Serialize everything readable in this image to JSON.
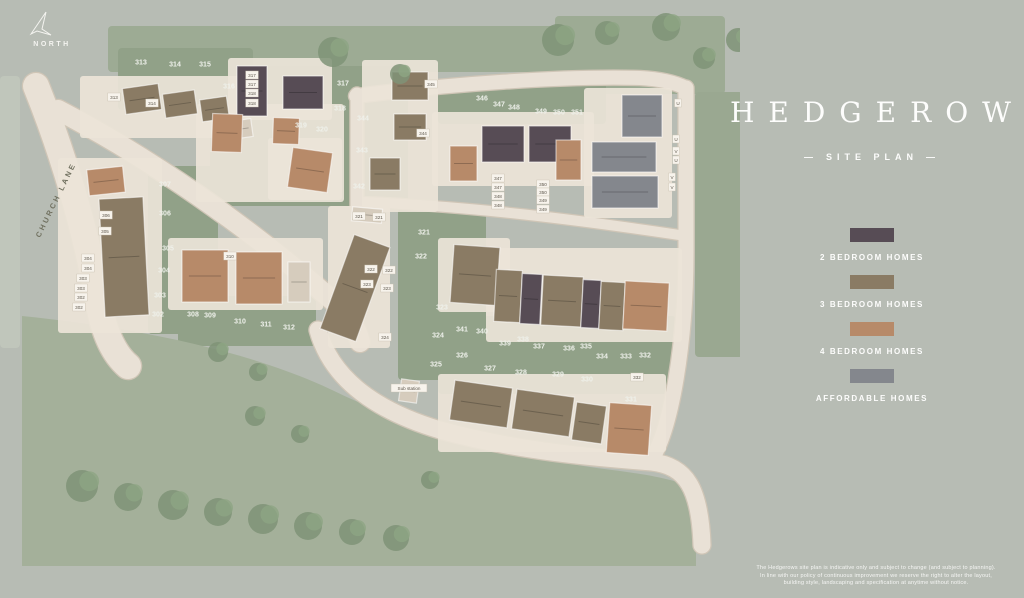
{
  "panel": {
    "title": "HEDGEROWS",
    "subtitle": "SITE PLAN",
    "subtitle_dash": "—",
    "legend": {
      "items": [
        {
          "label": "2 BEDROOM HOMES",
          "color": "#574c55"
        },
        {
          "label": "3 BEDROOM HOMES",
          "color": "#8a7b64"
        },
        {
          "label": "4 BEDROOM HOMES",
          "color": "#b78a69"
        },
        {
          "label": "AFFORDABLE HOMES",
          "color": "#84878d"
        }
      ]
    },
    "disclaimer": [
      "The Hedgerows site plan is indicative only and subject to change (and subject to planning).",
      "In line with our policy of continuous improvement we reserve the right to alter the layout,",
      "building style, landscaping and specification at anytime without notice."
    ]
  },
  "map": {
    "north_label": "NORTH",
    "road_label": "CHURCH LANE",
    "colors": {
      "green": "#91a188",
      "field": "#a4b09a",
      "tree": "#7f9377",
      "tree2": "#8da583",
      "road": "#e9e1d6",
      "road_edge": "#cfc5b6",
      "parcel": "#ebe4d8",
      "b2": "#574c55",
      "b3": "#8a7b64",
      "b4": "#b78a69",
      "af": "#84878d",
      "g": "#d6ccbd",
      "label": "#eff1eb",
      "box_bg": "#f7f3ec",
      "box_text": "#5c564b",
      "lane_text": "#70705f"
    },
    "patches": [
      {
        "x": 108,
        "y": 26,
        "w": 615,
        "h": 46,
        "f": "#9dab94"
      },
      {
        "x": 555,
        "y": 16,
        "w": 170,
        "h": 78,
        "f": "#9dab94"
      },
      {
        "x": 118,
        "y": 48,
        "w": 135,
        "h": 62
      },
      {
        "x": 210,
        "y": 66,
        "w": 150,
        "h": 140
      },
      {
        "x": 338,
        "y": 66,
        "w": 70,
        "h": 140
      },
      {
        "x": 438,
        "y": 82,
        "w": 168,
        "h": 42
      },
      {
        "x": 148,
        "y": 166,
        "w": 70,
        "h": 168
      },
      {
        "x": 178,
        "y": 296,
        "w": 138,
        "h": 50
      },
      {
        "x": 398,
        "y": 208,
        "w": 88,
        "h": 172
      },
      {
        "x": 438,
        "y": 316,
        "w": 238,
        "h": 78
      },
      {
        "x": 695,
        "y": 92,
        "w": 48,
        "h": 265,
        "f": "#9aa891"
      },
      {
        "d": "M 22,316 C 140,328 252,352 332,390 C 402,424 500,456 612,470 C 652,475 682,481 696,490 L 696,566 L 22,566 Z",
        "f": "#a4b09a"
      },
      {
        "x": 0,
        "y": 76,
        "w": 20,
        "h": 272,
        "f": "#c0c6bb"
      }
    ],
    "roads": [
      {
        "d": "M 36,86 C 62,150 86,230 98,300 C 104,334 114,354 128,366",
        "w": 26
      },
      {
        "d": "M 58,110 C 150,158 250,228 332,300 C 348,314 356,326 360,342",
        "w": 20
      },
      {
        "d": "M 318,330 C 332,382 380,412 440,430 C 520,452 600,458 652,462 C 686,466 700,488 702,545",
        "w": 17
      },
      {
        "d": "M 686,88 L 686,250 C 686,340 672,430 650,462",
        "w": 15
      },
      {
        "d": "M 356,96 C 450,84 560,76 640,78 C 660,79 674,82 686,88",
        "w": 14
      },
      {
        "d": "M 357,94 L 357,206",
        "w": 13
      },
      {
        "d": "M 360,202 C 470,206 580,220 686,236",
        "w": 10
      }
    ],
    "parcels": [
      {
        "x": 80,
        "y": 76,
        "w": 162,
        "h": 62
      },
      {
        "x": 228,
        "y": 58,
        "w": 104,
        "h": 62
      },
      {
        "x": 196,
        "y": 104,
        "w": 148,
        "h": 98
      },
      {
        "x": 268,
        "y": 138,
        "w": 74,
        "h": 62
      },
      {
        "x": 362,
        "y": 60,
        "w": 76,
        "h": 152
      },
      {
        "x": 432,
        "y": 112,
        "w": 162,
        "h": 74
      },
      {
        "x": 584,
        "y": 88,
        "w": 88,
        "h": 130
      },
      {
        "x": 58,
        "y": 158,
        "w": 104,
        "h": 175
      },
      {
        "x": 168,
        "y": 238,
        "w": 155,
        "h": 72
      },
      {
        "x": 328,
        "y": 206,
        "w": 62,
        "h": 142
      },
      {
        "x": 438,
        "y": 238,
        "w": 72,
        "h": 74
      },
      {
        "x": 486,
        "y": 248,
        "w": 196,
        "h": 94
      },
      {
        "x": 438,
        "y": 374,
        "w": 228,
        "h": 78
      }
    ],
    "trees": [
      {
        "x": 333,
        "y": 52,
        "r": 15
      },
      {
        "x": 400,
        "y": 74,
        "r": 10
      },
      {
        "x": 558,
        "y": 40,
        "r": 16
      },
      {
        "x": 607,
        "y": 33,
        "r": 12
      },
      {
        "x": 666,
        "y": 27,
        "r": 14
      },
      {
        "x": 704,
        "y": 58,
        "r": 11
      },
      {
        "x": 738,
        "y": 40,
        "r": 12
      },
      {
        "x": 218,
        "y": 352,
        "r": 10
      },
      {
        "x": 258,
        "y": 372,
        "r": 9
      },
      {
        "x": 82,
        "y": 486,
        "r": 16
      },
      {
        "x": 128,
        "y": 497,
        "r": 14
      },
      {
        "x": 173,
        "y": 505,
        "r": 15
      },
      {
        "x": 218,
        "y": 512,
        "r": 14
      },
      {
        "x": 263,
        "y": 519,
        "r": 15
      },
      {
        "x": 308,
        "y": 526,
        "r": 14
      },
      {
        "x": 352,
        "y": 532,
        "r": 13
      },
      {
        "x": 396,
        "y": 538,
        "r": 13
      },
      {
        "x": 255,
        "y": 416,
        "r": 10
      },
      {
        "x": 300,
        "y": 434,
        "r": 9
      },
      {
        "x": 430,
        "y": 480,
        "r": 9
      }
    ],
    "houses": [
      {
        "x": 124,
        "y": 86,
        "w": 36,
        "h": 26,
        "r": -8,
        "c": "b3"
      },
      {
        "x": 164,
        "y": 92,
        "w": 32,
        "h": 24,
        "r": -8,
        "c": "b3"
      },
      {
        "x": 201,
        "y": 98,
        "w": 27,
        "h": 22,
        "r": -8,
        "c": "b3"
      },
      {
        "x": 230,
        "y": 120,
        "w": 22,
        "h": 18,
        "r": -8,
        "c": "g"
      },
      {
        "x": 237,
        "y": 66,
        "w": 30,
        "h": 50,
        "r": 0,
        "c": "b2"
      },
      {
        "x": 283,
        "y": 76,
        "w": 40,
        "h": 33,
        "r": 0,
        "c": "b2"
      },
      {
        "x": 212,
        "y": 114,
        "w": 30,
        "h": 38,
        "r": 2,
        "c": "b4"
      },
      {
        "x": 273,
        "y": 118,
        "w": 26,
        "h": 26,
        "r": 2,
        "c": "b4"
      },
      {
        "x": 290,
        "y": 150,
        "w": 40,
        "h": 40,
        "r": 8,
        "c": "b4"
      },
      {
        "x": 392,
        "y": 72,
        "w": 36,
        "h": 28,
        "r": 0,
        "c": "b3"
      },
      {
        "x": 394,
        "y": 114,
        "w": 32,
        "h": 26,
        "r": 0,
        "c": "b3"
      },
      {
        "x": 370,
        "y": 158,
        "w": 30,
        "h": 32,
        "r": 0,
        "c": "b3"
      },
      {
        "x": 450,
        "y": 146,
        "w": 27,
        "h": 35,
        "r": 0,
        "c": "b4"
      },
      {
        "x": 482,
        "y": 126,
        "w": 42,
        "h": 36,
        "r": 0,
        "c": "b2"
      },
      {
        "x": 529,
        "y": 126,
        "w": 42,
        "h": 36,
        "r": 0,
        "c": "b2"
      },
      {
        "x": 556,
        "y": 140,
        "w": 25,
        "h": 40,
        "r": 0,
        "c": "b4"
      },
      {
        "x": 622,
        "y": 95,
        "w": 40,
        "h": 42,
        "r": 0,
        "c": "af"
      },
      {
        "x": 592,
        "y": 142,
        "w": 64,
        "h": 30,
        "r": 0,
        "c": "af"
      },
      {
        "x": 592,
        "y": 176,
        "w": 66,
        "h": 32,
        "r": 0,
        "c": "af"
      },
      {
        "x": 88,
        "y": 168,
        "w": 36,
        "h": 26,
        "r": -6,
        "c": "b4"
      },
      {
        "x": 102,
        "y": 198,
        "w": 44,
        "h": 118,
        "r": -3,
        "c": "b3"
      },
      {
        "x": 182,
        "y": 250,
        "w": 46,
        "h": 52,
        "r": 0,
        "c": "b4"
      },
      {
        "x": 236,
        "y": 252,
        "w": 46,
        "h": 52,
        "r": 0,
        "c": "b4"
      },
      {
        "x": 288,
        "y": 262,
        "w": 22,
        "h": 40,
        "r": 0,
        "c": "g"
      },
      {
        "x": 336,
        "y": 238,
        "w": 38,
        "h": 100,
        "r": 20,
        "c": "b3"
      },
      {
        "x": 352,
        "y": 208,
        "w": 30,
        "h": 14,
        "r": 5,
        "c": "g"
      },
      {
        "x": 452,
        "y": 246,
        "w": 46,
        "h": 58,
        "r": 4,
        "c": "b3"
      },
      {
        "x": 495,
        "y": 270,
        "w": 26,
        "h": 52,
        "r": 3,
        "c": "b3"
      },
      {
        "x": 521,
        "y": 274,
        "w": 20,
        "h": 50,
        "r": 3,
        "c": "b2"
      },
      {
        "x": 542,
        "y": 276,
        "w": 40,
        "h": 50,
        "r": 3,
        "c": "b3"
      },
      {
        "x": 582,
        "y": 280,
        "w": 18,
        "h": 48,
        "r": 3,
        "c": "b2"
      },
      {
        "x": 600,
        "y": 282,
        "w": 24,
        "h": 48,
        "r": 3,
        "c": "b3"
      },
      {
        "x": 624,
        "y": 282,
        "w": 44,
        "h": 48,
        "r": 3,
        "c": "b4"
      },
      {
        "x": 452,
        "y": 384,
        "w": 58,
        "h": 40,
        "r": 8,
        "c": "b3"
      },
      {
        "x": 514,
        "y": 393,
        "w": 58,
        "h": 40,
        "r": 8,
        "c": "b3"
      },
      {
        "x": 574,
        "y": 404,
        "w": 30,
        "h": 38,
        "r": 8,
        "c": "b3"
      },
      {
        "x": 608,
        "y": 404,
        "w": 42,
        "h": 50,
        "r": 4,
        "c": "b4"
      },
      {
        "x": 400,
        "y": 380,
        "w": 18,
        "h": 22,
        "r": 8,
        "c": "g"
      }
    ],
    "plot_labels": [
      {
        "t": "313",
        "x": 141,
        "y": 62
      },
      {
        "t": "314",
        "x": 175,
        "y": 64
      },
      {
        "t": "315",
        "x": 205,
        "y": 64
      },
      {
        "t": "316",
        "x": 229,
        "y": 86
      },
      {
        "t": "317",
        "x": 343,
        "y": 83
      },
      {
        "t": "318",
        "x": 340,
        "y": 108
      },
      {
        "t": "319",
        "x": 301,
        "y": 125
      },
      {
        "t": "320",
        "x": 322,
        "y": 129
      },
      {
        "t": "344",
        "x": 363,
        "y": 118
      },
      {
        "t": "343",
        "x": 362,
        "y": 150
      },
      {
        "t": "342",
        "x": 359,
        "y": 186
      },
      {
        "t": "307",
        "x": 165,
        "y": 184
      },
      {
        "t": "306",
        "x": 165,
        "y": 213
      },
      {
        "t": "305",
        "x": 168,
        "y": 248
      },
      {
        "t": "304",
        "x": 164,
        "y": 270
      },
      {
        "t": "303",
        "x": 160,
        "y": 295
      },
      {
        "t": "302",
        "x": 158,
        "y": 314
      },
      {
        "t": "308",
        "x": 193,
        "y": 314
      },
      {
        "t": "309",
        "x": 210,
        "y": 315
      },
      {
        "t": "310",
        "x": 240,
        "y": 321
      },
      {
        "t": "311",
        "x": 266,
        "y": 324
      },
      {
        "t": "312",
        "x": 289,
        "y": 327
      },
      {
        "t": "321",
        "x": 424,
        "y": 232
      },
      {
        "t": "322",
        "x": 421,
        "y": 256
      },
      {
        "t": "323",
        "x": 442,
        "y": 307
      },
      {
        "t": "324",
        "x": 438,
        "y": 335
      },
      {
        "t": "325",
        "x": 436,
        "y": 364
      },
      {
        "t": "326",
        "x": 462,
        "y": 355
      },
      {
        "t": "327",
        "x": 490,
        "y": 368
      },
      {
        "t": "328",
        "x": 521,
        "y": 372
      },
      {
        "t": "329",
        "x": 558,
        "y": 374
      },
      {
        "t": "330",
        "x": 587,
        "y": 379
      },
      {
        "t": "331",
        "x": 631,
        "y": 399
      },
      {
        "t": "341",
        "x": 462,
        "y": 329
      },
      {
        "t": "340",
        "x": 482,
        "y": 331
      },
      {
        "t": "339",
        "x": 505,
        "y": 343
      },
      {
        "t": "338",
        "x": 523,
        "y": 339
      },
      {
        "t": "337",
        "x": 539,
        "y": 346
      },
      {
        "t": "336",
        "x": 569,
        "y": 348
      },
      {
        "t": "335",
        "x": 586,
        "y": 346
      },
      {
        "t": "334",
        "x": 602,
        "y": 356
      },
      {
        "t": "333",
        "x": 626,
        "y": 356
      },
      {
        "t": "332",
        "x": 645,
        "y": 355
      },
      {
        "t": "346",
        "x": 482,
        "y": 98
      },
      {
        "t": "347",
        "x": 499,
        "y": 104
      },
      {
        "t": "348",
        "x": 514,
        "y": 107
      },
      {
        "t": "349",
        "x": 541,
        "y": 111
      },
      {
        "t": "350",
        "x": 559,
        "y": 112
      },
      {
        "t": "351",
        "x": 577,
        "y": 112
      }
    ],
    "box_labels": [
      {
        "t": "317",
        "x": 252,
        "y": 75
      },
      {
        "t": "317",
        "x": 252,
        "y": 84
      },
      {
        "t": "318",
        "x": 252,
        "y": 93
      },
      {
        "t": "318",
        "x": 252,
        "y": 103
      },
      {
        "t": "347",
        "x": 498,
        "y": 178
      },
      {
        "t": "347",
        "x": 498,
        "y": 187
      },
      {
        "t": "348",
        "x": 498,
        "y": 196
      },
      {
        "t": "348",
        "x": 498,
        "y": 205
      },
      {
        "t": "350",
        "x": 543,
        "y": 184
      },
      {
        "t": "350",
        "x": 543,
        "y": 192
      },
      {
        "t": "349",
        "x": 543,
        "y": 200
      },
      {
        "t": "349",
        "x": 543,
        "y": 209
      },
      {
        "t": "306",
        "x": 106,
        "y": 215
      },
      {
        "t": "305",
        "x": 105,
        "y": 231
      },
      {
        "t": "304",
        "x": 88,
        "y": 258
      },
      {
        "t": "304",
        "x": 88,
        "y": 268
      },
      {
        "t": "303",
        "x": 83,
        "y": 278
      },
      {
        "t": "303",
        "x": 81,
        "y": 288
      },
      {
        "t": "302",
        "x": 81,
        "y": 297
      },
      {
        "t": "302",
        "x": 79,
        "y": 307
      },
      {
        "t": "321",
        "x": 359,
        "y": 216
      },
      {
        "t": "321",
        "x": 379,
        "y": 217
      },
      {
        "t": "322",
        "x": 371,
        "y": 269
      },
      {
        "t": "322",
        "x": 389,
        "y": 270
      },
      {
        "t": "323",
        "x": 367,
        "y": 284
      },
      {
        "t": "323",
        "x": 387,
        "y": 288
      },
      {
        "t": "324",
        "x": 385,
        "y": 337
      },
      {
        "t": "332",
        "x": 637,
        "y": 377
      },
      {
        "t": "345",
        "x": 431,
        "y": 84
      },
      {
        "t": "344",
        "x": 423,
        "y": 133
      },
      {
        "t": "313",
        "x": 114,
        "y": 97
      },
      {
        "t": "314",
        "x": 152,
        "y": 103
      },
      {
        "t": "310",
        "x": 230,
        "y": 256
      },
      {
        "t": "U",
        "x": 678,
        "y": 103
      },
      {
        "t": "U",
        "x": 676,
        "y": 139
      },
      {
        "t": "V",
        "x": 676,
        "y": 151
      },
      {
        "t": "U",
        "x": 676,
        "y": 160
      },
      {
        "t": "V",
        "x": 672,
        "y": 177
      },
      {
        "t": "V",
        "x": 672,
        "y": 187
      },
      {
        "t": "Sub station",
        "x": 409,
        "y": 388
      }
    ]
  }
}
